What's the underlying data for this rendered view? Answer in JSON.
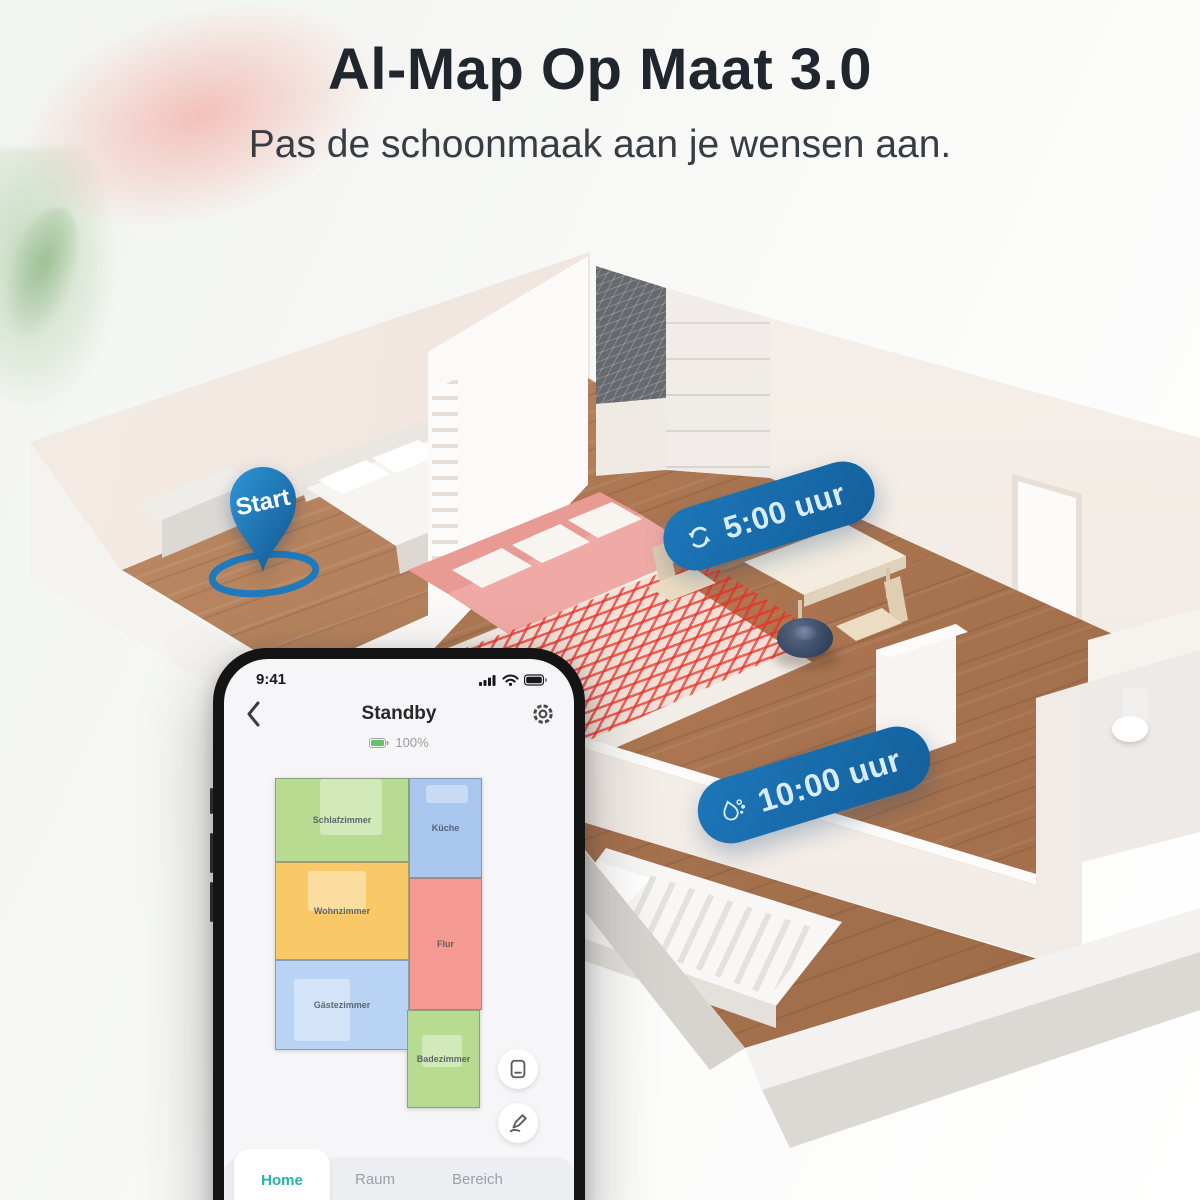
{
  "header": {
    "title": "Al-Map Op Maat 3.0",
    "subtitle": "Pas de schoonmaak aan je wensen aan."
  },
  "scene": {
    "start_pin": {
      "label": "Start",
      "icon": "location-pin-icon",
      "color": "#1f7ec2"
    },
    "badges": [
      {
        "label": "5:00 uur",
        "icon": "spin-cycle-icon"
      },
      {
        "label": "10:00 uur",
        "icon": "water-drop-icon"
      }
    ],
    "robot": {
      "icon": "robot-vacuum",
      "color": "#394a67"
    },
    "colors": {
      "badge_blue": "#1a6cb0",
      "no_go_red": "#e6392e",
      "floor_wood": "#ae7851",
      "wall_cream": "#f3eae3",
      "sofa_pink": "#efaaa5"
    }
  },
  "phone": {
    "status_bar": {
      "time": "9:41",
      "icons": [
        "signal-icon",
        "wifi-icon",
        "battery-icon"
      ]
    },
    "header": {
      "back_icon": "chevron-left-icon",
      "title": "Standby",
      "battery_icon": "battery-level-icon",
      "battery_percent": "100%",
      "settings_icon": "gear-icon"
    },
    "map": {
      "rooms": [
        {
          "name": "Schlafzimmer",
          "color": "#b7db90"
        },
        {
          "name": "Küche",
          "color": "#a9c6ee"
        },
        {
          "name": "Wohnzimmer",
          "color": "#f9c967"
        },
        {
          "name": "Flur",
          "color": "#f49a92"
        },
        {
          "name": "Gästezimmer",
          "color": "#b9d3f4"
        },
        {
          "name": "Badezimmer",
          "color": "#b7db90"
        }
      ]
    },
    "side_buttons": [
      {
        "icon": "map-list-icon"
      },
      {
        "icon": "map-edit-icon"
      }
    ],
    "tabs": [
      {
        "label": "Home",
        "active": true
      },
      {
        "label": "Raum",
        "active": false
      },
      {
        "label": "Bereich",
        "active": false
      }
    ],
    "accent_teal": "#26b3a4"
  }
}
